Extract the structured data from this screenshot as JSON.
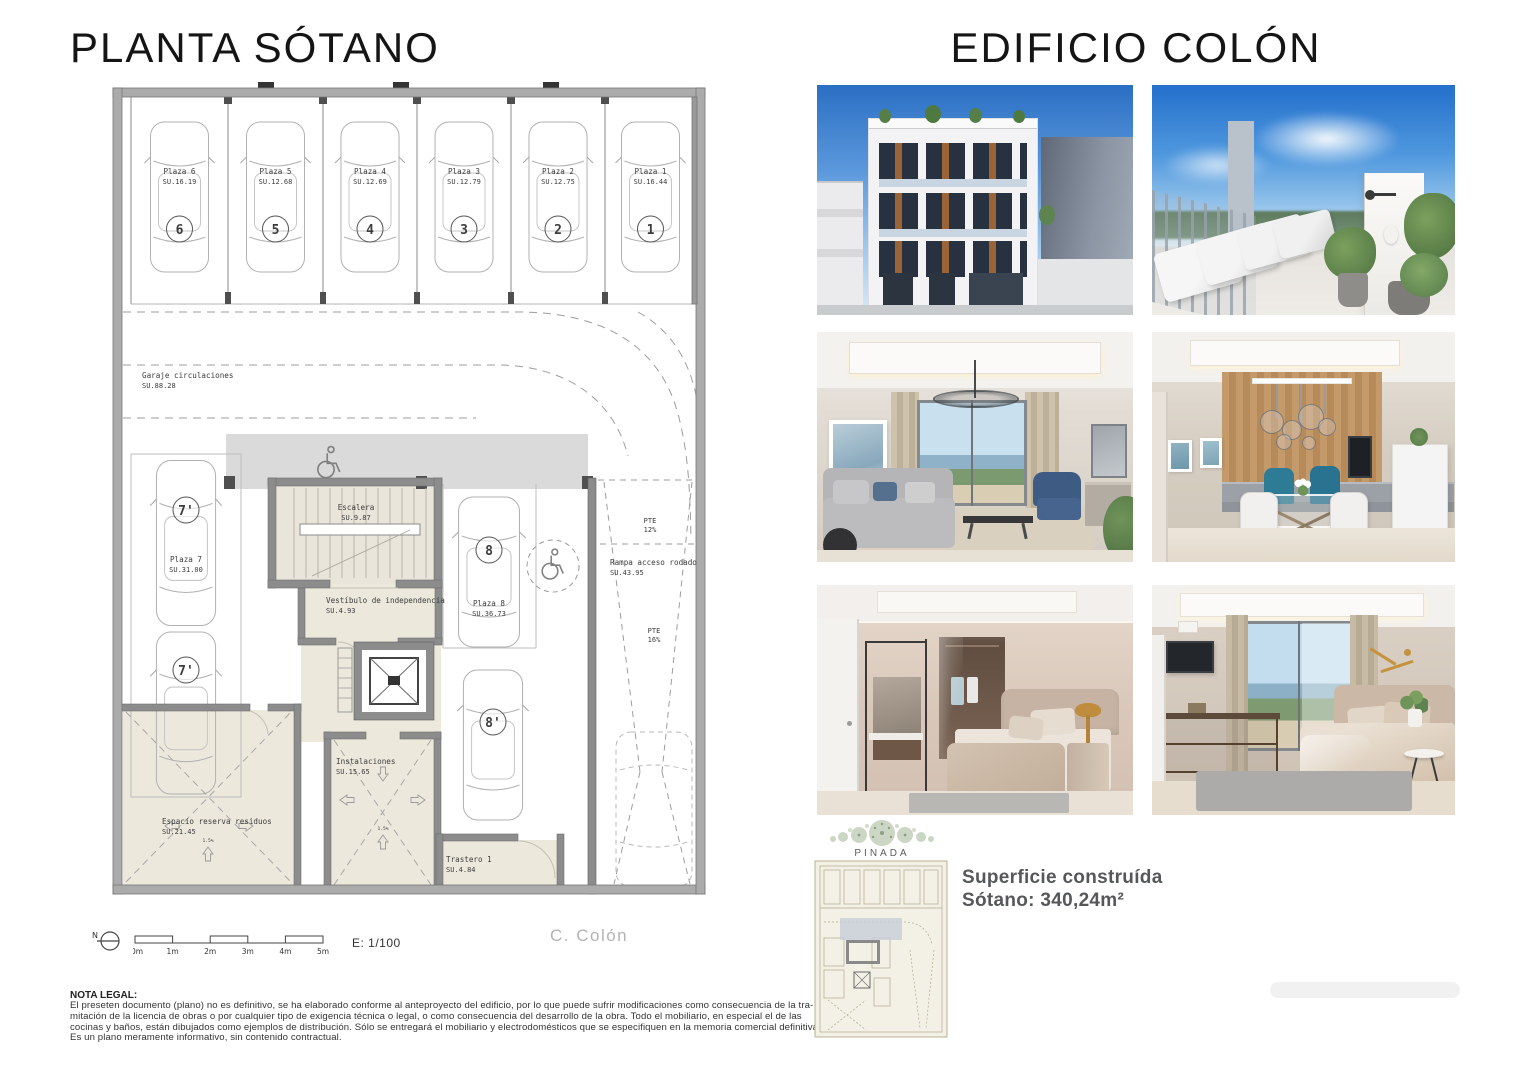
{
  "titles": {
    "left": "PLANTA SÓTANO",
    "right": "EDIFICIO COLÓN"
  },
  "plan": {
    "stalls": [
      {
        "label": "Plaza 6",
        "area": "SU.16.19",
        "num": "6"
      },
      {
        "label": "Plaza 5",
        "area": "SU.12.68",
        "num": "5"
      },
      {
        "label": "Plaza 4",
        "area": "SU.12.69",
        "num": "4"
      },
      {
        "label": "Plaza 3",
        "area": "SU.12.79",
        "num": "3"
      },
      {
        "label": "Plaza 2",
        "area": "SU.12.75",
        "num": "2"
      },
      {
        "label": "Plaza 1",
        "area": "SU.16.44",
        "num": "1"
      }
    ],
    "garaje": {
      "label": "Garaje circulaciones",
      "area": "SU.88.28"
    },
    "plaza7": {
      "label": "Plaza 7",
      "area": "SU.31.00",
      "num": "7'"
    },
    "plaza8": {
      "label": "Plaza 8",
      "area": "SU.36.73",
      "num": "8",
      "num_alt": "8'"
    },
    "escalera": {
      "label": "Escalera",
      "area": "SU.9.87"
    },
    "vestibulo": {
      "label": "Vestíbulo de independencia",
      "area": "SU.4.93"
    },
    "rampa": {
      "label": "Rampa acceso rodado",
      "area": "SU.43.95"
    },
    "residuos": {
      "label": "Espacio reserva residuos",
      "area": "SU.21.45"
    },
    "instalaciones": {
      "label": "Instalaciones",
      "area": "SU.15.65"
    },
    "trastero": {
      "label": "Trastero 1",
      "area": "SU.4.84"
    },
    "pte_upper": {
      "label": "PTE",
      "value": "12%"
    },
    "pte_lower": {
      "label": "PTE",
      "value": "16%"
    },
    "slope_label": "1.5%",
    "north_label": "N",
    "scale_ticks": [
      "0m",
      "1m",
      "2m",
      "3m",
      "4m",
      "5m"
    ],
    "scale_ratio": "E: 1/100",
    "street_label": "C. Colón"
  },
  "legal": {
    "heading": "NOTA LEGAL:",
    "lines": [
      "El preseten documento (plano) no es definitivo, se ha elaborado conforme al anteproyecto del edificio, por lo que puede sufrir modificaciones como consecuencia de la tra-",
      "mitación de la licencia de obras o por cualquier tipo de exigencia técnica o legal, o como consecuencia del desarrollo de la obra. Todo el mobiliario, en especial el de las",
      "cocinas y baños, están dibujados como ejemplos de distribución. Sólo se entregará el mobiliario y electrodomésticos que se especifiquen en la memoria comercial definitiva.",
      "Es un plano meramente informativo, sin contenido contractual."
    ]
  },
  "summary": {
    "brand": "PINADA",
    "line1": "Superficie construída",
    "line2": "Sótano: 340,24m²"
  },
  "photos": [
    {
      "name": "building-facade-render"
    },
    {
      "name": "rooftop-terrace-render"
    },
    {
      "name": "living-room-render"
    },
    {
      "name": "dining-kitchen-render"
    },
    {
      "name": "bedroom-dressing-render"
    },
    {
      "name": "bedroom-seaview-render"
    }
  ],
  "colors": {
    "sky_blue": "#2e76cc",
    "plan_wall": "#ababab",
    "plan_beige": "#ece8dc",
    "band_gray": "#dadada",
    "text_dark": "#3c3c3c",
    "street_gray": "#b3b3b3",
    "summary_gray": "#55575a",
    "brand_green": "#a9bb9d"
  }
}
